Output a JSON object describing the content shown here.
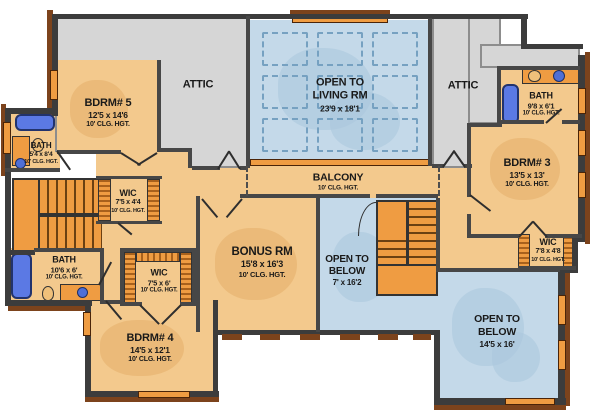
{
  "palette": {
    "floor_tan": "#f3c98d",
    "accent_orange": "#ef9c42",
    "open_area_blue": "#c4d9e9",
    "attic_gray": "#d6d6d6",
    "wall_dark": "#3c3c3c",
    "trim_brown": "#7c431c",
    "tub_blue": "#5b79e4",
    "text": "#191919",
    "background": "#ffffff"
  },
  "rooms": {
    "attic_left": {
      "lines": [
        "ATTIC"
      ]
    },
    "attic_right": {
      "lines": [
        "ATTIC"
      ]
    },
    "bdrm5": {
      "lines": [
        "BDRM# 5",
        "12'5 x 14'6",
        "10' CLG. HGT."
      ]
    },
    "bath_upper_left": {
      "lines": [
        "BATH",
        "5'4 x 8'4",
        "10' CLG. HGT."
      ]
    },
    "wic_upper_left": {
      "lines": [
        "WIC",
        "7'5 x 4'4",
        "10' CLG. HGT."
      ]
    },
    "open_living": {
      "lines": [
        "OPEN TO",
        "LIVING RM",
        "23'9 x 18'1"
      ]
    },
    "balcony": {
      "lines": [
        "BALCONY",
        "10' CLG. HGT."
      ]
    },
    "bath_right": {
      "lines": [
        "BATH",
        "9'8 x 6'1",
        "10' CLG. HGT."
      ]
    },
    "bdrm3": {
      "lines": [
        "BDRM# 3",
        "13'5 x 13'",
        "10' CLG. HGT."
      ]
    },
    "wic_right": {
      "lines": [
        "WIC",
        "7'8 x 4'8",
        "10' CLG. HGT."
      ]
    },
    "bonus": {
      "lines": [
        "BONUS RM",
        "15'8 x 16'3",
        "10' CLG. HGT."
      ]
    },
    "open_below_center": {
      "lines": [
        "OPEN TO",
        "BELOW",
        "7' x 16'2"
      ]
    },
    "bath_lower_left": {
      "lines": [
        "BATH",
        "10'6 x 6'",
        "10' CLG. HGT."
      ]
    },
    "wic_lower_left": {
      "lines": [
        "WIC",
        "7'5 x 6'",
        "10' CLG. HGT."
      ]
    },
    "bdrm4": {
      "lines": [
        "BDRM# 4",
        "14'5 x 12'1",
        "10' CLG. HGT."
      ]
    },
    "open_below_right": {
      "lines": [
        "OPEN TO",
        "BELOW",
        "14'5 x 16'"
      ]
    }
  }
}
